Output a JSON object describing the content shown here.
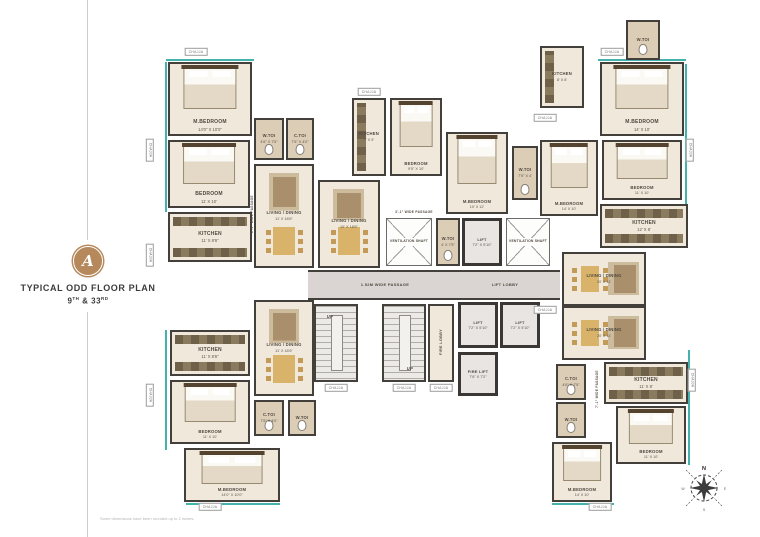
{
  "branding": {
    "badge_letter": "A",
    "badge_color": "#b5895b",
    "title": "TYPICAL ODD FLOOR PLAN",
    "floor_number": "9",
    "floor_suffix": "TH",
    "floor_join": " & ",
    "floor_number2": "33",
    "floor_suffix2": "RD"
  },
  "footnote": "Some dimensions have been rounded up to 2 inches.",
  "compass": {
    "north": "N",
    "east": "E",
    "south": "S",
    "west": "W"
  },
  "colors": {
    "wall": "#433f3b",
    "floor": "#f0e9db",
    "passage": "#dad5d2",
    "toilet_tile": "#dccdb7",
    "teal_edge": "#45b3ad",
    "counter": "#6f6049",
    "table": "#d9b369",
    "badge": "#b5895b"
  },
  "plan": {
    "chajja_label": "CHAJJA",
    "rooms": [
      {
        "x": 168,
        "y": 62,
        "w": 84,
        "h": 74,
        "l": "M.BEDROOM",
        "d": "14'0\" X 10'0\"",
        "c": "bedded",
        "f": "bed"
      },
      {
        "x": 168,
        "y": 140,
        "w": 82,
        "h": 68,
        "l": "BEDROOM",
        "d": "11' X 10'",
        "c": "bedded",
        "f": "bed"
      },
      {
        "x": 254,
        "y": 118,
        "w": 30,
        "h": 42,
        "l": "W.TOI",
        "d": "4'6\" X 7'5\"",
        "c": "toilet sm",
        "f": "wc"
      },
      {
        "x": 286,
        "y": 118,
        "w": 28,
        "h": 42,
        "l": "C.TOI",
        "d": "7'5\" X 4'0\"",
        "c": "toilet sm",
        "f": "wc"
      },
      {
        "x": 168,
        "y": 212,
        "w": 84,
        "h": 50,
        "l": "KITCHEN",
        "d": "11' X 8'6\"",
        "c": "",
        "f": "counter"
      },
      {
        "x": 254,
        "y": 164,
        "w": 60,
        "h": 104,
        "l": "LIVING / DINING",
        "d": "11' X 18'6\"",
        "c": "sm",
        "f": "living"
      },
      {
        "x": 318,
        "y": 180,
        "w": 62,
        "h": 88,
        "l": "LIVING / DINING",
        "d": "10' X 18'6\"",
        "c": "sm",
        "f": "living"
      },
      {
        "x": 352,
        "y": 98,
        "w": 34,
        "h": 78,
        "l": "KITCHEN",
        "d": "7' X 9'",
        "c": "sm",
        "f": "counter-v"
      },
      {
        "x": 390,
        "y": 98,
        "w": 52,
        "h": 78,
        "l": "BEDROOM",
        "d": "9'5\" X 10'",
        "c": "bedded sm",
        "f": "bed"
      },
      {
        "x": 446,
        "y": 132,
        "w": 62,
        "h": 82,
        "l": "M.BEDROOM",
        "d": "10' X 12'",
        "c": "bedded sm",
        "f": "bed"
      },
      {
        "x": 512,
        "y": 146,
        "w": 26,
        "h": 54,
        "l": "W.TOI",
        "d": "7'5\" X 4'",
        "c": "toilet sm",
        "f": "wc"
      },
      {
        "x": 386,
        "y": 218,
        "w": 46,
        "h": 48,
        "l": "VENTILATION SHAFT",
        "d": "",
        "c": "shaft",
        "f": ""
      },
      {
        "x": 436,
        "y": 218,
        "w": 24,
        "h": 48,
        "l": "W.TOI",
        "d": "4' X 7'5\"",
        "c": "toilet sm",
        "f": "wc"
      },
      {
        "x": 462,
        "y": 218,
        "w": 40,
        "h": 48,
        "l": "LIFT",
        "d": "7'2\" X 5'10\"",
        "c": "lift sm",
        "f": ""
      },
      {
        "x": 506,
        "y": 218,
        "w": 44,
        "h": 48,
        "l": "VENTILATION SHAFT",
        "d": "",
        "c": "shaft",
        "f": ""
      },
      {
        "x": 314,
        "y": 304,
        "w": 44,
        "h": 78,
        "l": "",
        "d": "",
        "c": "stair",
        "f": ""
      },
      {
        "x": 382,
        "y": 304,
        "w": 44,
        "h": 78,
        "l": "",
        "d": "",
        "c": "stair",
        "f": ""
      },
      {
        "x": 428,
        "y": 304,
        "w": 26,
        "h": 78,
        "l": "",
        "d": "",
        "c": "",
        "f": ""
      },
      {
        "x": 458,
        "y": 302,
        "w": 40,
        "h": 46,
        "l": "LIFT",
        "d": "7'2\" X 5'10\"",
        "c": "lift sm",
        "f": ""
      },
      {
        "x": 500,
        "y": 302,
        "w": 40,
        "h": 46,
        "l": "LIFT",
        "d": "7'2\" X 5'10\"",
        "c": "lift sm",
        "f": ""
      },
      {
        "x": 458,
        "y": 352,
        "w": 40,
        "h": 44,
        "l": "FIRE LIFT",
        "d": "7'6\" X 7'2\"",
        "c": "lift sm",
        "f": ""
      },
      {
        "x": 540,
        "y": 46,
        "w": 44,
        "h": 62,
        "l": "KITCHEN",
        "d": "8' X 8'",
        "c": "sm",
        "f": "counter-v"
      },
      {
        "x": 540,
        "y": 140,
        "w": 58,
        "h": 76,
        "l": "M.BEDROOM",
        "d": "14' X 10'",
        "c": "bedded sm",
        "f": "bed"
      },
      {
        "x": 600,
        "y": 62,
        "w": 84,
        "h": 74,
        "l": "M.BEDROOM",
        "d": "14' X 10'",
        "c": "bedded",
        "f": "bed"
      },
      {
        "x": 602,
        "y": 140,
        "w": 80,
        "h": 60,
        "l": "BEDROOM",
        "d": "11' X 10'",
        "c": "bedded sm",
        "f": "bed"
      },
      {
        "x": 600,
        "y": 204,
        "w": 88,
        "h": 44,
        "l": "KITCHEN",
        "d": "12' X 8'",
        "c": "",
        "f": "counter"
      },
      {
        "x": 562,
        "y": 252,
        "w": 84,
        "h": 54,
        "l": "LIVING / DINING",
        "d": "20' X 11'",
        "c": "sm",
        "f": "living-w"
      },
      {
        "x": 626,
        "y": 20,
        "w": 34,
        "h": 40,
        "l": "W.TOI",
        "d": "",
        "c": "toilet sm",
        "f": "wc"
      },
      {
        "x": 562,
        "y": 306,
        "w": 84,
        "h": 54,
        "l": "LIVING / DINING",
        "d": "20' X 11'",
        "c": "sm",
        "f": "living-w"
      },
      {
        "x": 604,
        "y": 362,
        "w": 84,
        "h": 42,
        "l": "KITCHEN",
        "d": "11' X 8'",
        "c": "",
        "f": "counter"
      },
      {
        "x": 616,
        "y": 406,
        "w": 70,
        "h": 58,
        "l": "BEDROOM",
        "d": "11' X 10'",
        "c": "bedded sm",
        "f": "bed"
      },
      {
        "x": 552,
        "y": 442,
        "w": 60,
        "h": 60,
        "l": "M.BEDROOM",
        "d": "14' X 10'",
        "c": "bedded sm",
        "f": "bed"
      },
      {
        "x": 556,
        "y": 364,
        "w": 30,
        "h": 36,
        "l": "C.TOI",
        "d": "4'6\" X 7'5\"",
        "c": "toilet sm",
        "f": "wc"
      },
      {
        "x": 556,
        "y": 402,
        "w": 30,
        "h": 36,
        "l": "W.TOI",
        "d": "",
        "c": "toilet sm",
        "f": "wc"
      },
      {
        "x": 170,
        "y": 330,
        "w": 80,
        "h": 46,
        "l": "KITCHEN",
        "d": "11' X 8'6\"",
        "c": "",
        "f": "counter"
      },
      {
        "x": 170,
        "y": 380,
        "w": 80,
        "h": 64,
        "l": "BEDROOM",
        "d": "11' X 10'",
        "c": "bedded sm",
        "f": "bed"
      },
      {
        "x": 184,
        "y": 448,
        "w": 96,
        "h": 54,
        "l": "M.BEDROOM",
        "d": "14'0\" X 10'0\"",
        "c": "bedded sm",
        "f": "bed"
      },
      {
        "x": 254,
        "y": 300,
        "w": 60,
        "h": 96,
        "l": "LIVING / DINING",
        "d": "11' X 18'6\"",
        "c": "sm",
        "f": "living"
      },
      {
        "x": 254,
        "y": 400,
        "w": 30,
        "h": 36,
        "l": "C.TOI",
        "d": "7'5\" X 4'0\"",
        "c": "toilet sm",
        "f": "wc"
      },
      {
        "x": 288,
        "y": 400,
        "w": 28,
        "h": 36,
        "l": "W.TOI",
        "d": "",
        "c": "toilet sm",
        "f": "wc"
      }
    ],
    "passages": [
      {
        "x": 308,
        "y": 270,
        "w": 252,
        "h": 30
      }
    ],
    "texts": [
      {
        "x": 385,
        "y": 285,
        "t": "1.52M WIDE PASSAGE",
        "s": 4
      },
      {
        "x": 505,
        "y": 285,
        "t": "LIFT LOBBY",
        "s": 4
      },
      {
        "x": 330,
        "y": 317,
        "t": "UP",
        "s": 4.2
      },
      {
        "x": 410,
        "y": 369,
        "t": "UP",
        "s": 4.2
      },
      {
        "x": 441,
        "y": 343,
        "t": "FIRE LOBBY",
        "s": 3.8,
        "rot": 1
      },
      {
        "x": 252,
        "y": 215,
        "t": "2'-1\" WIDE PASSAGE",
        "s": 3.2,
        "rot": 1
      },
      {
        "x": 414,
        "y": 213,
        "t": "3'-1\" WIDE PASSAGE",
        "s": 3.2
      },
      {
        "x": 597,
        "y": 390,
        "t": "7'-1\" WIDE PASSAGE",
        "s": 3.2,
        "rot": 1
      }
    ],
    "chajjas": [
      {
        "x": 196,
        "y": 52
      },
      {
        "x": 150,
        "y": 150,
        "v": 1
      },
      {
        "x": 150,
        "y": 255,
        "v": 1
      },
      {
        "x": 150,
        "y": 395,
        "v": 1
      },
      {
        "x": 210,
        "y": 507
      },
      {
        "x": 612,
        "y": 52
      },
      {
        "x": 690,
        "y": 150,
        "v": 1
      },
      {
        "x": 692,
        "y": 380,
        "v": 1
      },
      {
        "x": 600,
        "y": 507
      },
      {
        "x": 336,
        "y": 388
      },
      {
        "x": 404,
        "y": 388
      },
      {
        "x": 441,
        "y": 388
      },
      {
        "x": 369,
        "y": 92
      },
      {
        "x": 545,
        "y": 118
      },
      {
        "x": 545,
        "y": 310
      }
    ],
    "teals": [
      {
        "x": 166,
        "y": 59,
        "w": 88,
        "h": 2
      },
      {
        "x": 165,
        "y": 62,
        "w": 2,
        "h": 150
      },
      {
        "x": 165,
        "y": 330,
        "w": 2,
        "h": 120
      },
      {
        "x": 186,
        "y": 503,
        "w": 94,
        "h": 2
      },
      {
        "x": 598,
        "y": 59,
        "w": 88,
        "h": 2
      },
      {
        "x": 685,
        "y": 64,
        "w": 2,
        "h": 140
      },
      {
        "x": 688,
        "y": 350,
        "w": 2,
        "h": 115
      },
      {
        "x": 552,
        "y": 503,
        "w": 62,
        "h": 2
      }
    ]
  }
}
